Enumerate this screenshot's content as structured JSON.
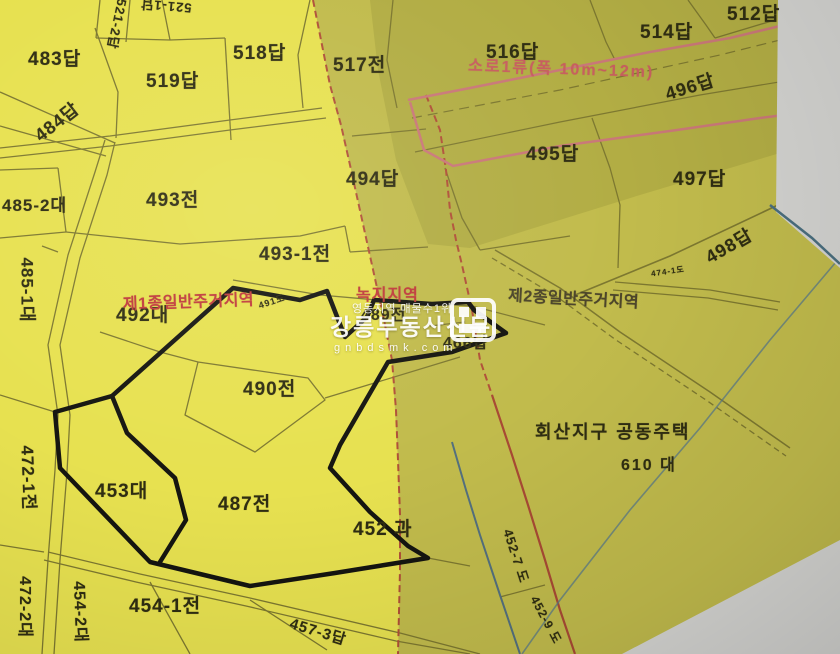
{
  "colors": {
    "bright_zone": "#e7e150",
    "olive_zone": "#c1bb4c",
    "dark_olive_zone": "#b2ad44",
    "paper_gray": "#d3d3d0",
    "zone_boundary_red": "#b05038",
    "road_edge_pink": "#c97878",
    "parcel_line_olive": "#7d7830",
    "subject_outline_black": "#151510",
    "water_line_blue": "#54707e",
    "label_dark": "#2f2d12",
    "label_red": "#c03a3a",
    "watermark_white": "#ffffff"
  },
  "zoning": {
    "zone1_label": "제1종일반주거지역",
    "zone2_label": "제2종일반주거지역",
    "green_zone_label": "녹지지역",
    "road_class_label": "소로1류(폭 10m~12m)"
  },
  "district": {
    "name": "회산지구 공동주택",
    "units": "610 대"
  },
  "watermark": {
    "tagline": "영동지역 매물수1위",
    "brand": "강릉부동산신문",
    "url": "gnbdsmk.com"
  },
  "parcels": {
    "p483": "483답",
    "p519": "519답",
    "p518": "518답",
    "p521_2": "521-2답",
    "p521_1": "521-1답",
    "p484": "484답",
    "p517": "517전",
    "p516": "516답",
    "p512": "512답",
    "p514": "514답",
    "p496": "496답",
    "p495": "495답",
    "p494": "494답",
    "p497": "497답",
    "p498": "498답",
    "p493": "493전",
    "p485_2": "485-2대",
    "p493_1": "493-1전",
    "p485_1": "485-1대",
    "p492": "492대",
    "p491": "491도",
    "p489": "489전",
    "p466": "466답",
    "p474_1": "474-1도",
    "p490": "490전",
    "p453": "453대",
    "p487": "487전",
    "p452": "452 과",
    "p472_1": "472-1전",
    "p472_2": "472-2대",
    "p454_2": "454-2대",
    "p454_1": "454-1전",
    "p457_3": "457-3답",
    "p452_7": "452-7 도",
    "p452_9": "452-9 도"
  }
}
